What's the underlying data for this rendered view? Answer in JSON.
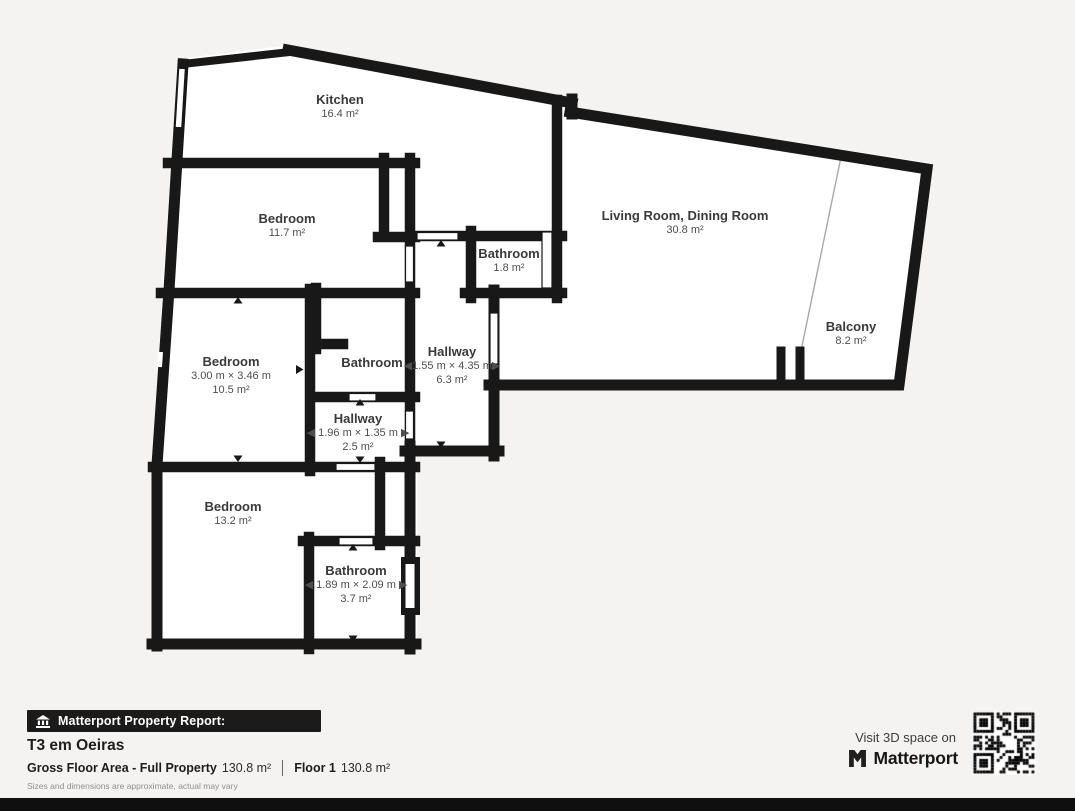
{
  "colors": {
    "background": "#f4f3f1",
    "wall": "#181818",
    "floor": "#ffffff",
    "badge_bg": "#1b1b1b",
    "label_text": "#3a3a3a"
  },
  "rooms": [
    {
      "id": "kitchen",
      "name": "Kitchen",
      "area": "16.4 m²"
    },
    {
      "id": "bedroom-1",
      "name": "Bedroom",
      "area": "11.7 m²"
    },
    {
      "id": "bathroom-small",
      "name": "Bathroom",
      "area": "1.8 m²"
    },
    {
      "id": "living-dining",
      "name": "Living Room, Dining Room",
      "area": "30.8 m²"
    },
    {
      "id": "balcony",
      "name": "Balcony",
      "area": "8.2 m²"
    },
    {
      "id": "bedroom-2",
      "name": "Bedroom",
      "dims": "3.00 m × 3.46 m",
      "area": "10.5 m²"
    },
    {
      "id": "bathroom-mid",
      "name": "Bathroom"
    },
    {
      "id": "hallway-main",
      "name": "Hallway",
      "dims": "◀1.55 m × 4.35 m▶",
      "area": "6.3 m²"
    },
    {
      "id": "hallway-small",
      "name": "Hallway",
      "dims": "◀ 1.96 m × 1.35 m ▶",
      "area": "2.5 m²"
    },
    {
      "id": "bedroom-3",
      "name": "Bedroom",
      "area": "13.2 m²"
    },
    {
      "id": "bathroom-suite",
      "name": "Bathroom",
      "dims": "◀ 1.89 m × 2.09 m ▶",
      "area": "3.7 m²"
    }
  ],
  "footer": {
    "badge_label": "Matterport Property Report:",
    "property_title": "T3 em Oeiras",
    "gross_area_label": "Gross Floor Area - Full Property",
    "gross_area_value": "130.8 m²",
    "floor_label": "Floor 1",
    "floor_value": "130.8 m²",
    "disclaimer": "Sizes and dimensions are approximate, actual may vary",
    "visit_text": "Visit 3D space on",
    "brand_name": "Matterport"
  }
}
